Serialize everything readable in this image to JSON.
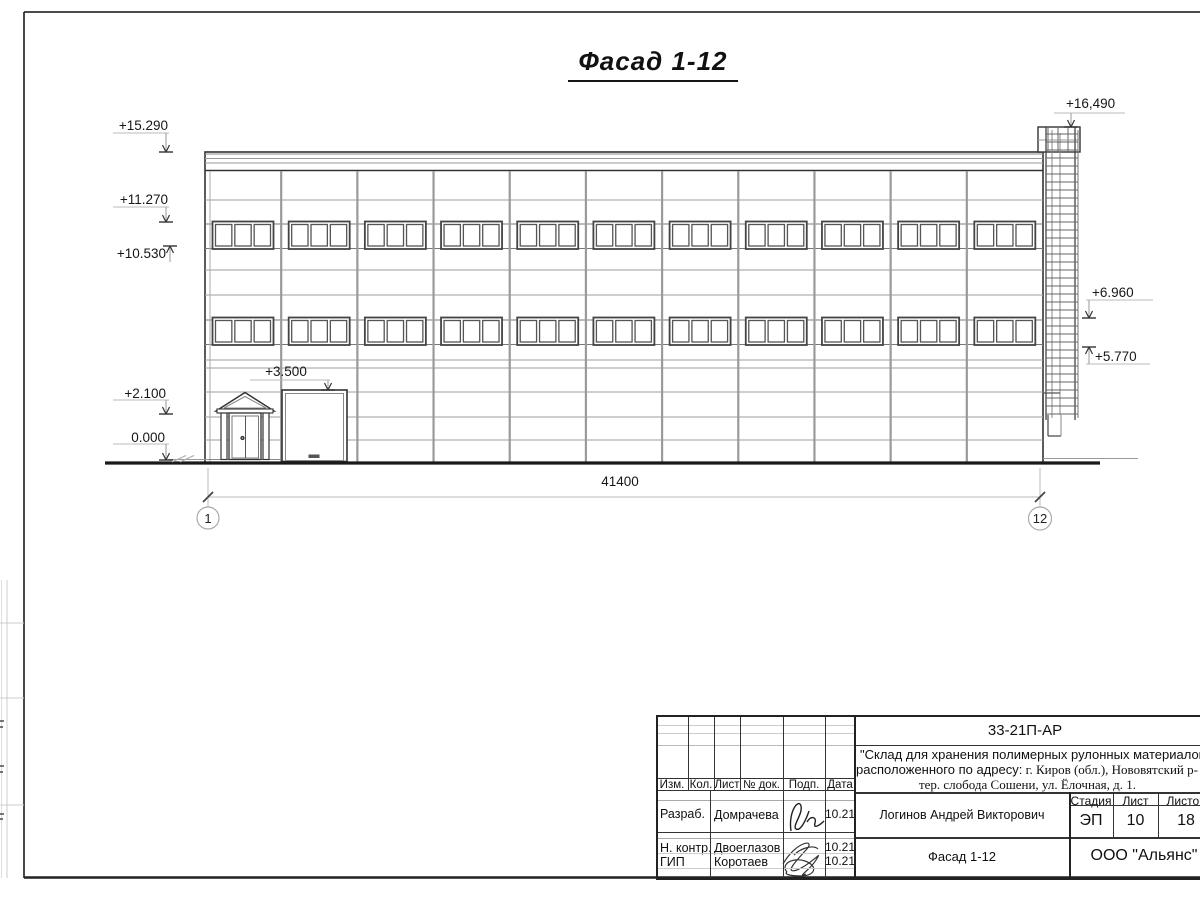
{
  "sheet": {
    "view_title": "Фасад 1-12 "
  },
  "dimension": {
    "total": "41400"
  },
  "grid": {
    "left": "1",
    "right": "12"
  },
  "levels": {
    "l1": "+15.290",
    "l2": "+11.270",
    "l3": "+10.530",
    "l4": "+2.100",
    "l5": "0.000",
    "l6": "+3.500",
    "r1": "+16,490",
    "r2": "+6.960",
    "r3": "+5.770"
  },
  "titleblock": {
    "doc_number": "33-21П-АР",
    "project_line1": "\"Склад для хранения полимерных рулонных материалов",
    "project_line2_sans": "расположенного по адресу:",
    "project_line2_serif": " г. Киров (обл.), Нововятский р-",
    "project_line3": "тер. слобода Сошени, ул. Ёлочная, д. 1.",
    "cols": {
      "izm": "Изм.",
      "kol": "Кол.",
      "list": "Лист",
      "doc": "№ док.",
      "podp": "Подп.",
      "data": "Дата"
    },
    "rows": [
      {
        "role": "Разраб.",
        "name": "Домрачева",
        "date": "10.21"
      },
      {
        "role": "Н. контр.",
        "name": "Двоеглазов",
        "date": "10.21"
      },
      {
        "role": "ГИП",
        "name": "Коротаев",
        "date": "10.21"
      }
    ],
    "approver": "Логинов Андрей Викторович",
    "stage_label": "Стадия",
    "sheet_label": "Лист",
    "sheets_label": "Листов",
    "stage": "ЭП",
    "sheet_no": "10",
    "sheets_total": "18",
    "drawing_title": "Фасад 1-12",
    "company": "ООО \"Альянс\""
  }
}
